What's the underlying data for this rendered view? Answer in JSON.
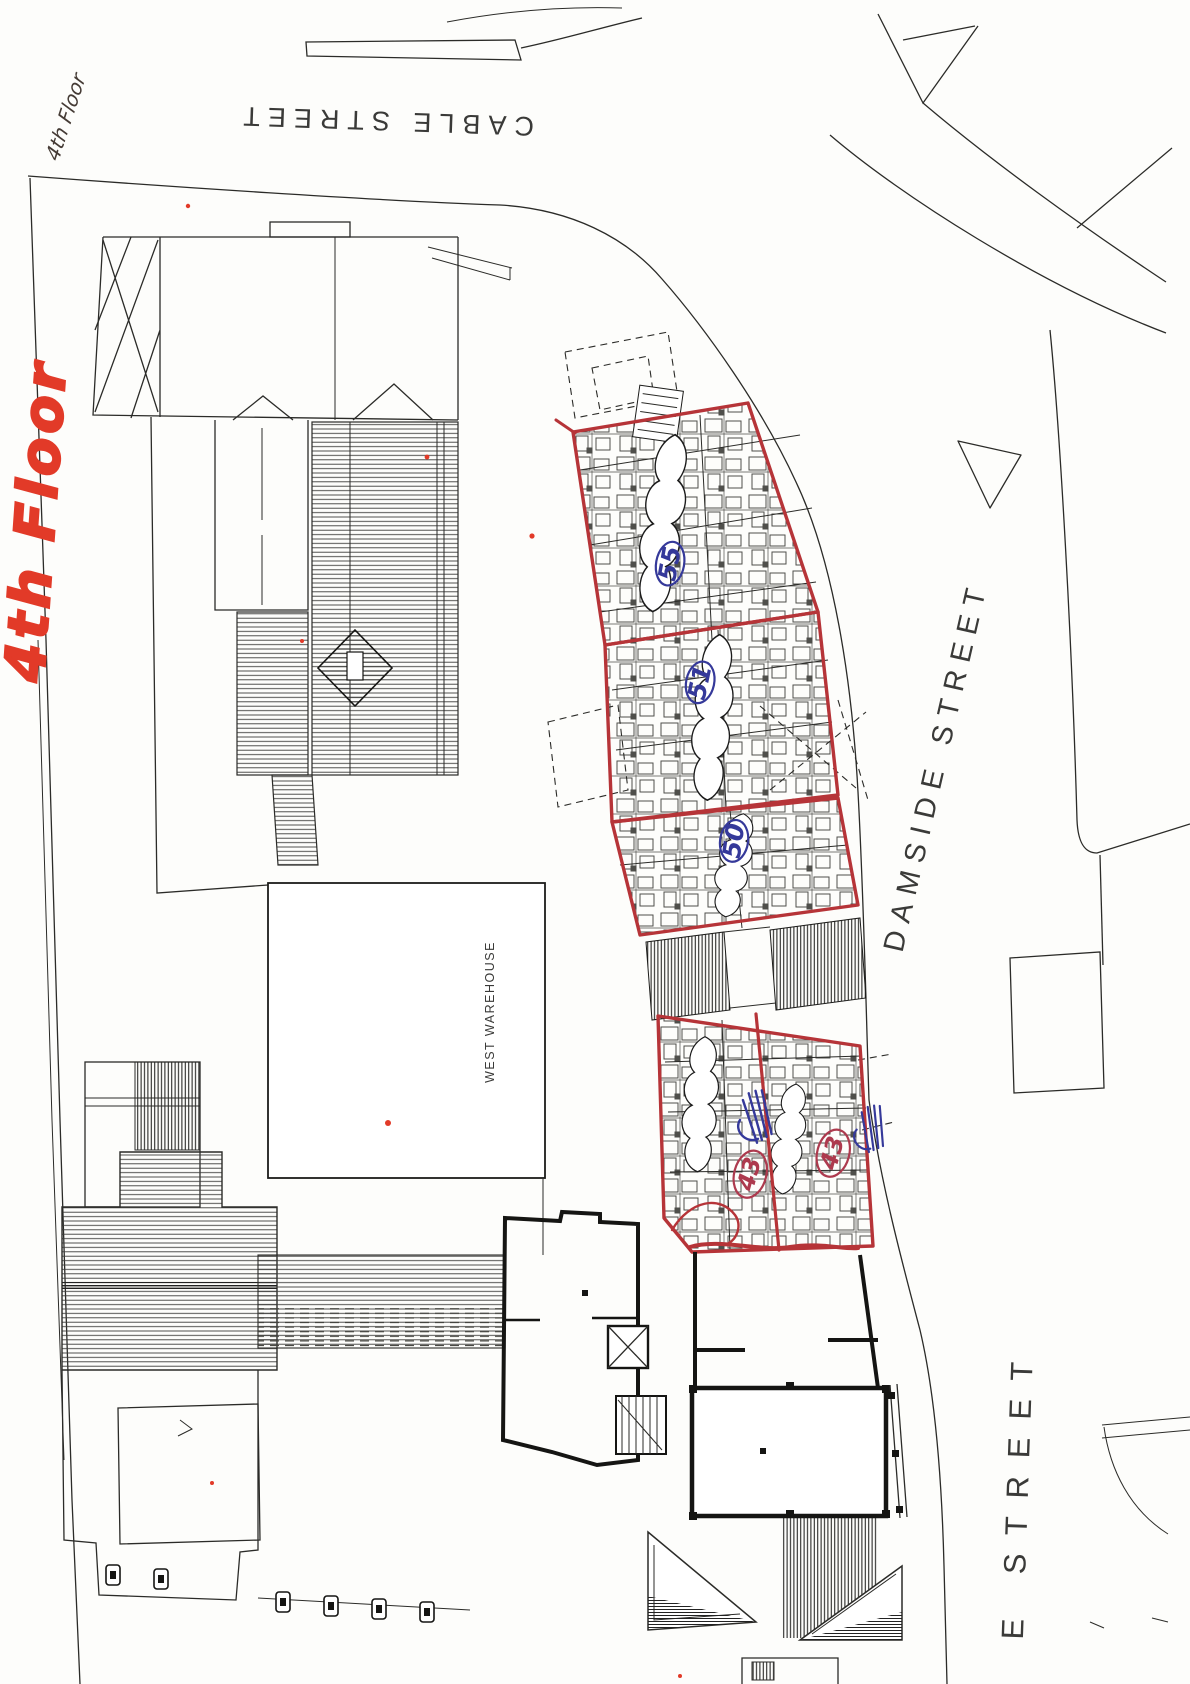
{
  "streets": {
    "cable": "CABLE STREET",
    "damside": "DAMSIDE STREET",
    "e_street": "E STREET"
  },
  "buildings": {
    "west_warehouse": "WEST WAREHOUSE"
  },
  "annotations": {
    "floor_note_small": "4th Floor",
    "floor_note_large": "4th Floor",
    "unit_numbers": [
      "55",
      "51",
      "50"
    ],
    "circled_numbers": [
      "43",
      "43"
    ]
  },
  "colors": {
    "paper": "#fdfdfb",
    "ink": "#2b2b28",
    "red_outline": "#b63438",
    "red_marker": "#e23a28",
    "blue_marker": "#35399a",
    "circled_red": "#ad3a4e"
  }
}
